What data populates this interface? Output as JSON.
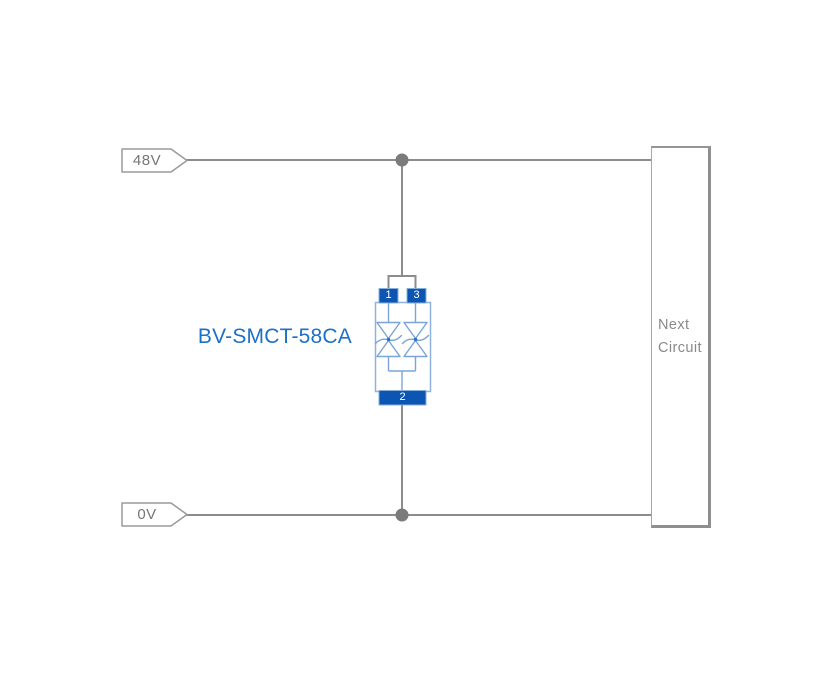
{
  "diagram": {
    "type": "circuit-schematic",
    "description": "TVS diode surge protection circuit between 48V rail and 0V rail, in parallel with next circuit block"
  },
  "rails": [
    {
      "id": "rail-48v",
      "label": "48V"
    },
    {
      "id": "rail-0v",
      "label": "0V"
    }
  ],
  "component": {
    "part_number": "BV-SMCT-58CA",
    "kind": "bidirectional TVS diode array, 3-pin SMD",
    "pins": [
      {
        "number": "1"
      },
      {
        "number": "3"
      },
      {
        "number": "2"
      }
    ]
  },
  "next_circuit": {
    "label": "Next Circuit"
  },
  "colors": {
    "background": "#ffffff",
    "wire": "#8c8c8c",
    "junction_dot": "#7b7b7b",
    "rail_tag_border": "#9a9a9a",
    "rail_tag_text": "#767676",
    "component_outline_blue": "#7aa5d6",
    "component_body_outline": "#8fb3dc",
    "component_pin_blue": "#0d55b2",
    "part_label_blue": "#1c70c6",
    "next_circuit_border": "#8f8f8f",
    "next_circuit_text": "#8a8a8a"
  }
}
